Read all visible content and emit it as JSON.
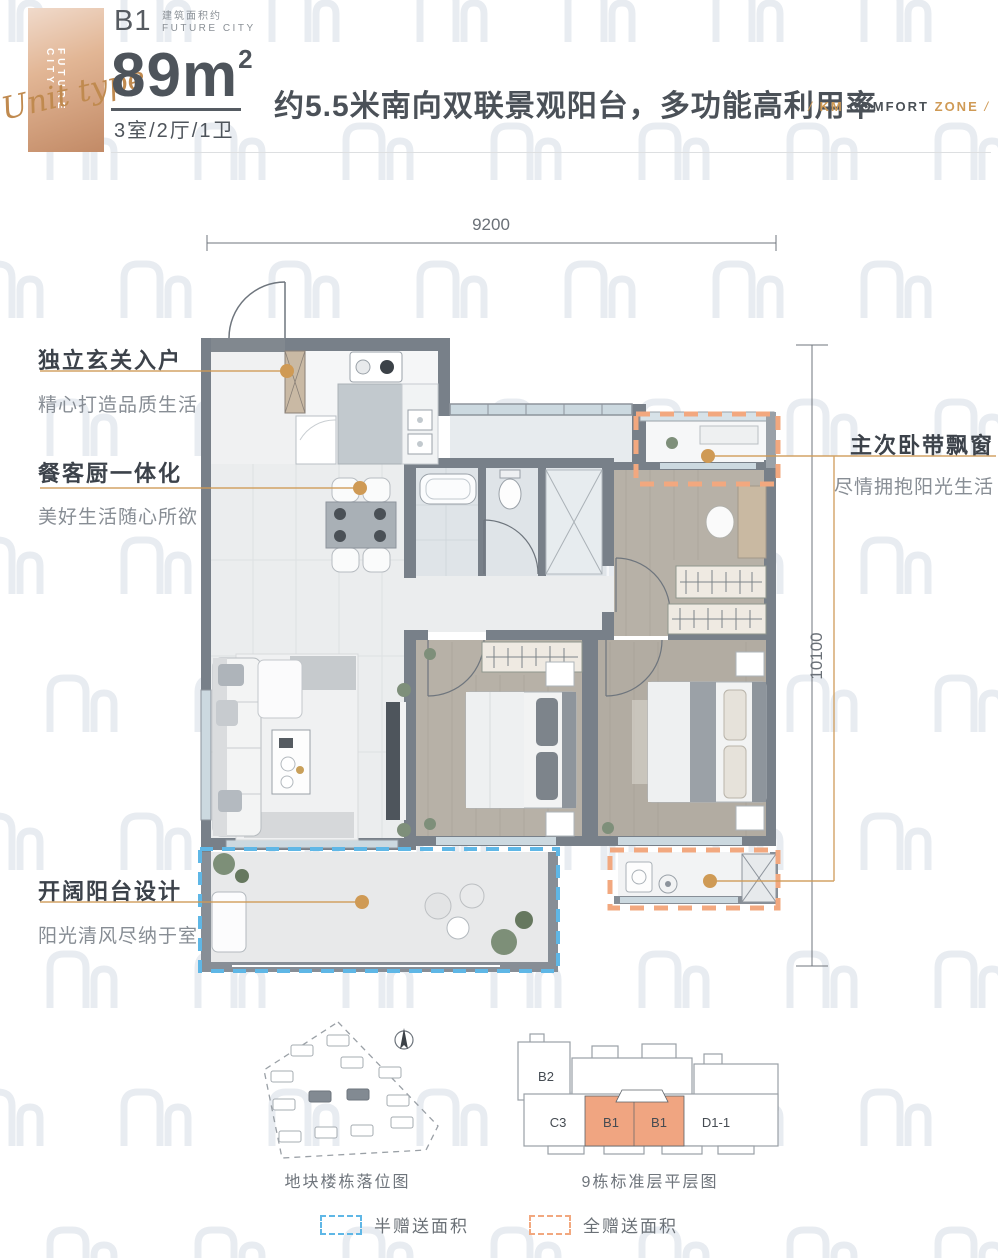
{
  "header": {
    "ribbon": {
      "script": "Unit type",
      "vertical_label": "FUTURE CITY"
    },
    "badge": {
      "code": "B1",
      "subtitle_cn": "建筑面积约",
      "subtitle_en": "FUTURE CITY"
    },
    "area": {
      "number": "89m",
      "exponent": "2"
    },
    "layout": "3室/2厅/1卫",
    "headline": "约5.5米南向双联景观阳台，多功能高利用率",
    "brand": {
      "slash_left": "/",
      "part1": "KM",
      "part2": "COMFORT",
      "part3": "ZONE",
      "slash_right": "/"
    }
  },
  "floorplan": {
    "dimensions": {
      "width": "9200",
      "height": "10100"
    },
    "callouts": [
      {
        "id": "entry",
        "title": "独立玄关入户",
        "subtitle": "精心打造品质生活"
      },
      {
        "id": "dining",
        "title": "餐客厨一体化",
        "subtitle": "美好生活随心所欲"
      },
      {
        "id": "baywindow",
        "title": "主次卧带飘窗",
        "subtitle": "尽情拥抱阳光生活"
      },
      {
        "id": "balcony",
        "title": "开阔阳台设计",
        "subtitle": "阳光清风尽纳于室"
      }
    ]
  },
  "diagrams": {
    "site_plan": {
      "caption": "地块楼栋落位图"
    },
    "floor_plan": {
      "caption": "9栋标准层平层图",
      "units": [
        "B2",
        "C3",
        "B1",
        "B1",
        "D1-1"
      ]
    }
  },
  "legend": {
    "items": [
      {
        "label": "半赠送面积",
        "color": "#5fb7e6"
      },
      {
        "label": "全赠送面积",
        "color": "#f2a87f"
      }
    ]
  },
  "colors": {
    "accent_copper": "#cf9a55",
    "dashed_blue": "#5fb7e6",
    "dashed_orange": "#f2a87f",
    "wall_gray": "#788089",
    "text_dark": "#4b5158",
    "text_gray": "#878d94"
  }
}
